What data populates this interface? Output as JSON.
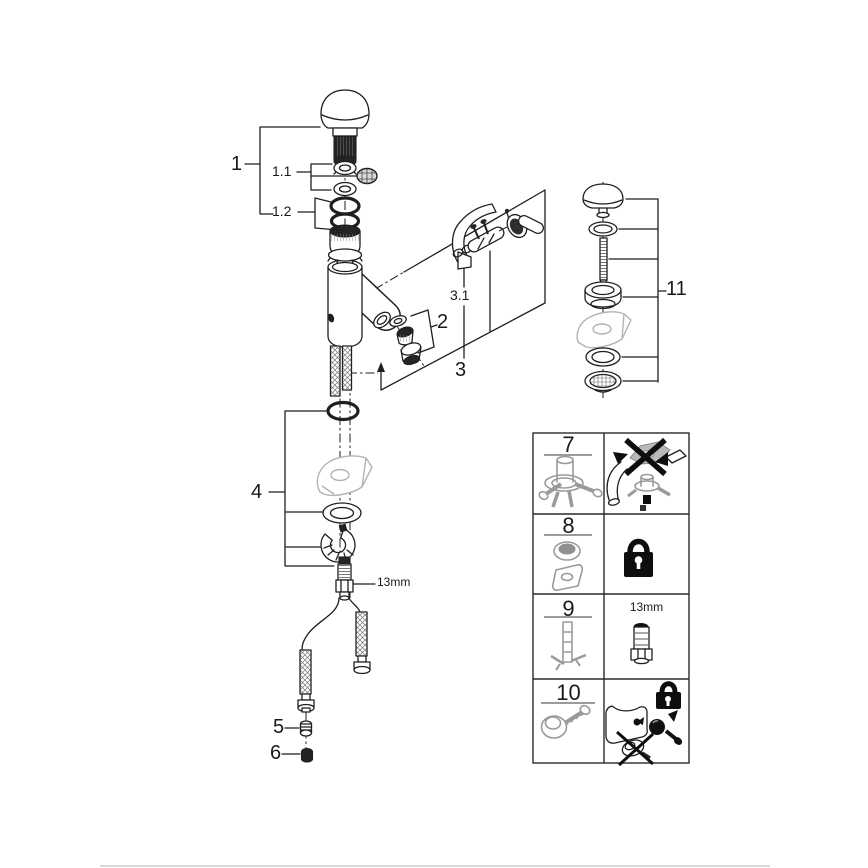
{
  "callouts": {
    "part1": "1",
    "part1_1": "1.1",
    "part1_2": "1.2",
    "part2": "2",
    "part3": "3",
    "part3_1": "3.1",
    "part4": "4",
    "part5": "5",
    "part6": "6",
    "part11": "11",
    "stud_size": "13mm"
  },
  "legend": {
    "rows": [
      {
        "number": "7",
        "note": ""
      },
      {
        "number": "8",
        "note": ""
      },
      {
        "number": "9",
        "note": "13mm"
      },
      {
        "number": "10",
        "note": ""
      }
    ]
  },
  "colors": {
    "line": "#1f1f1f",
    "ghost": "#b3b3b3",
    "icon": "#9a9a9a",
    "black": "#0e0e0e",
    "footer": "#cccccc",
    "bg": "#ffffff"
  }
}
